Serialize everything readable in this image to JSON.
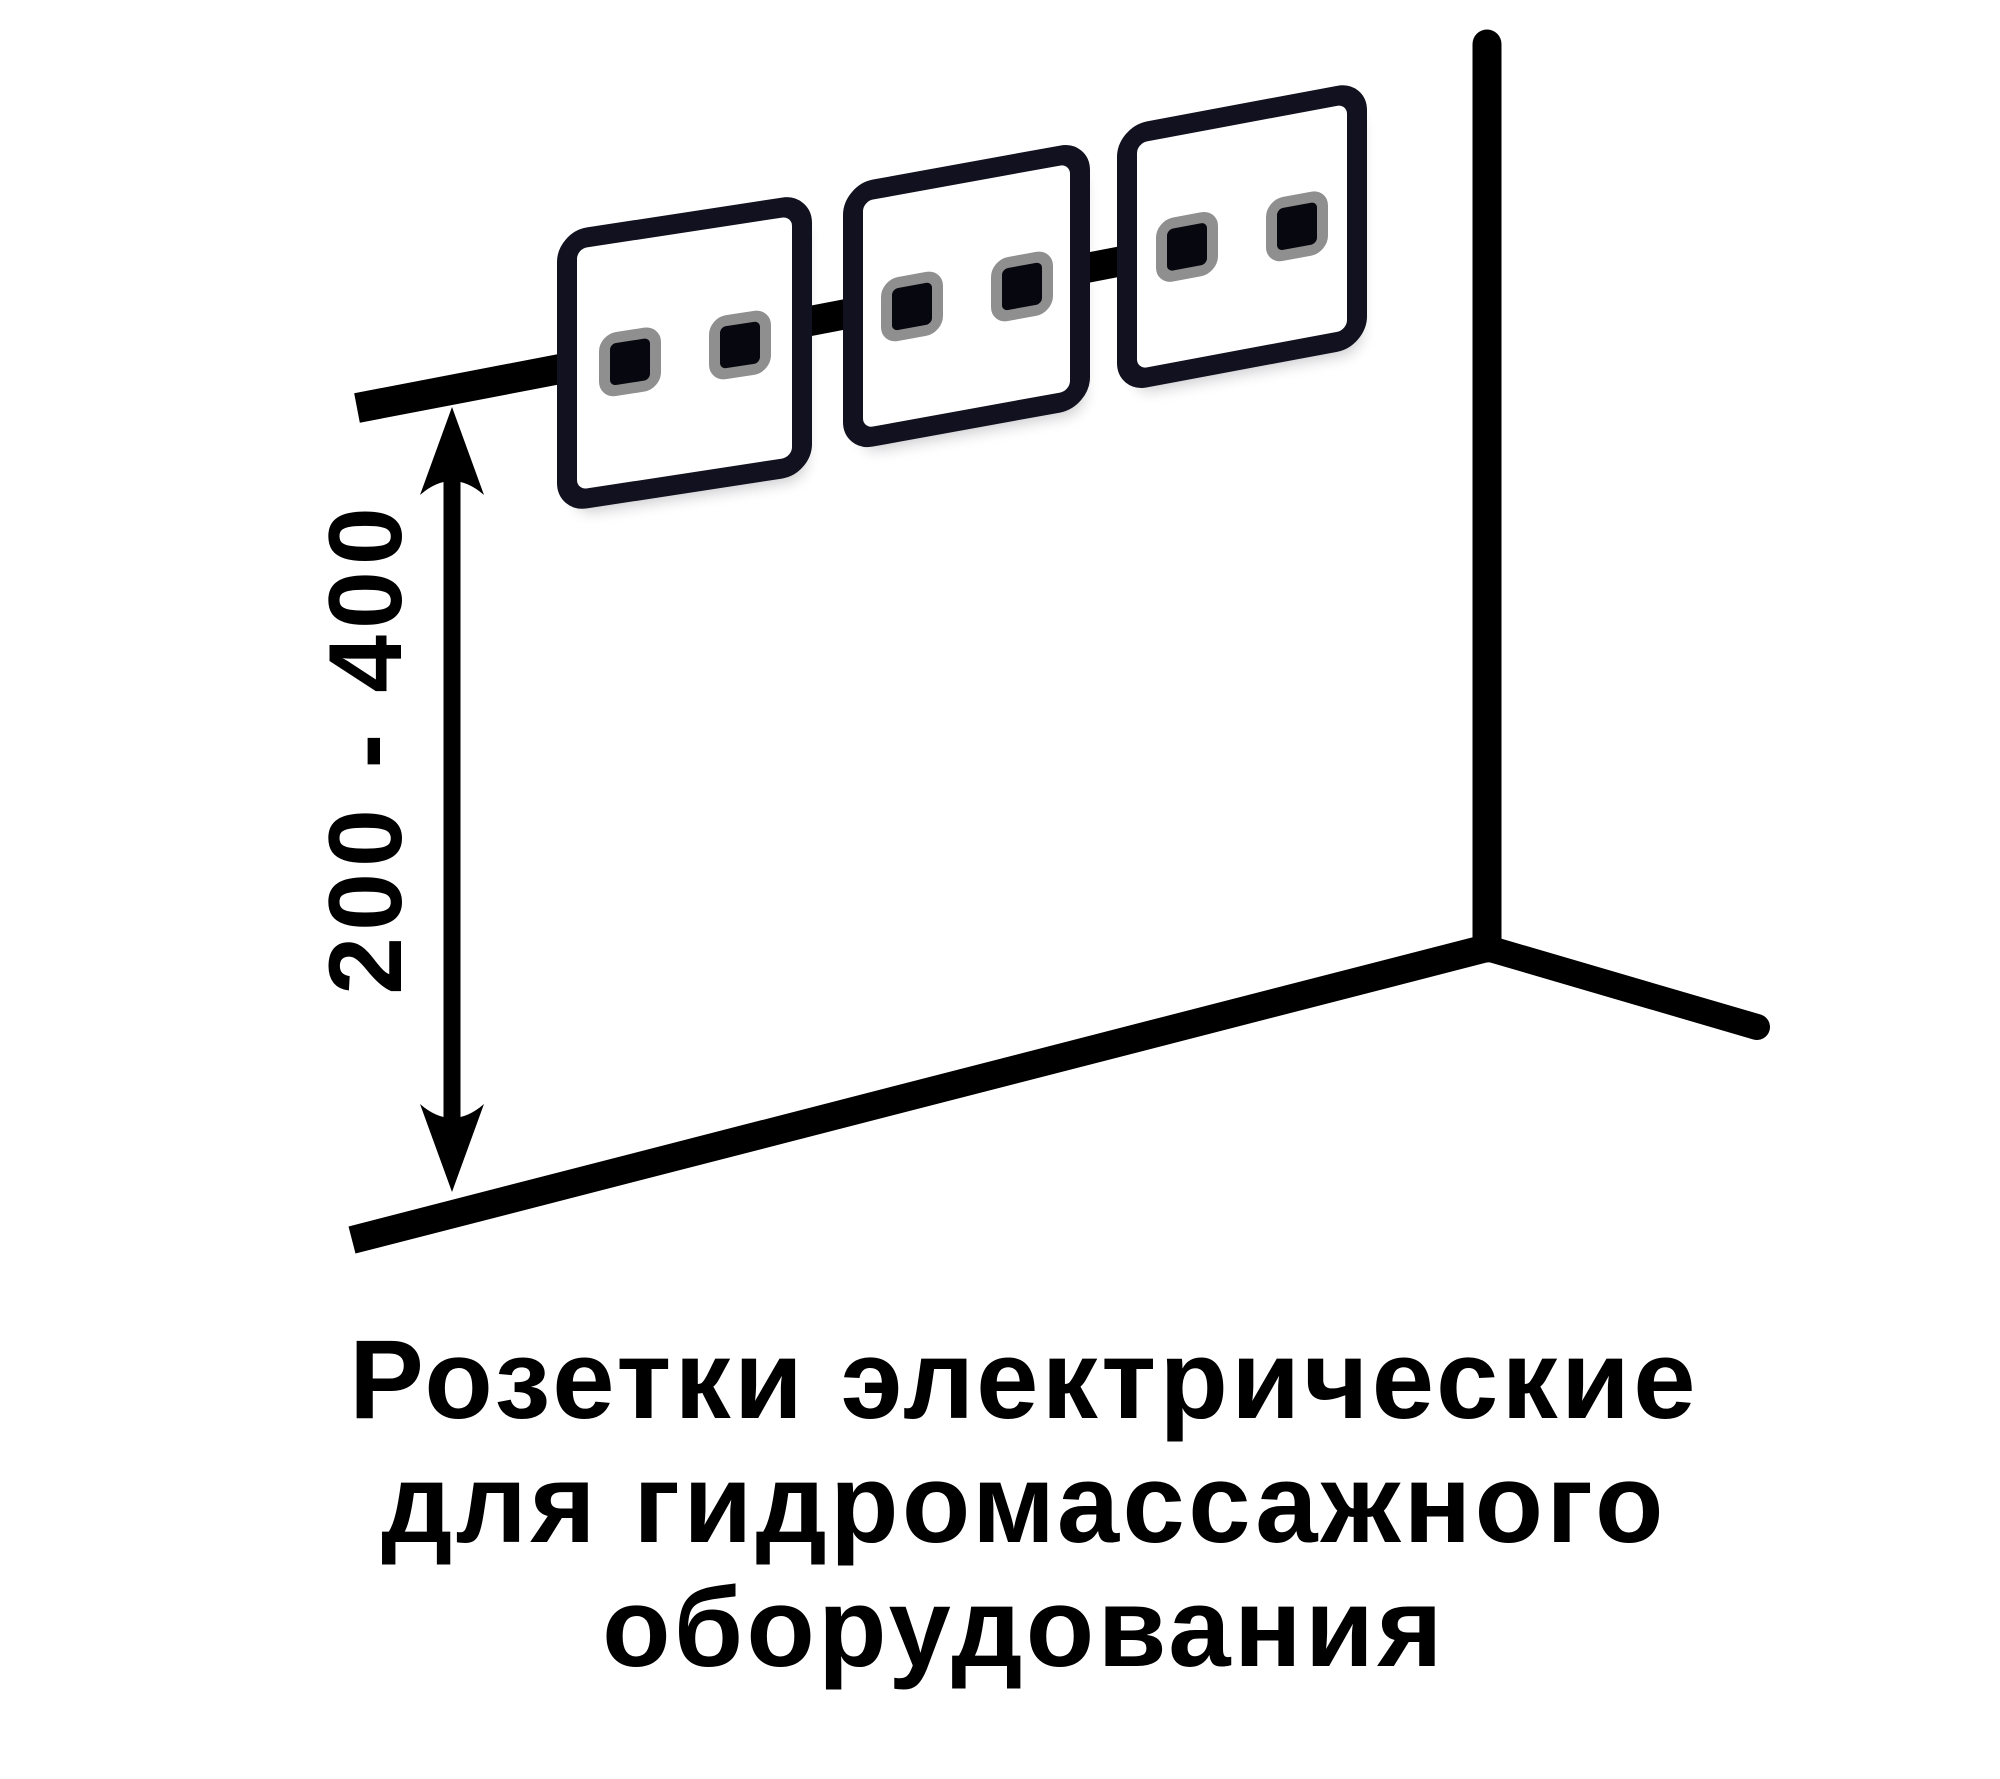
{
  "diagram": {
    "dimension_label": "200 - 400",
    "caption": {
      "line1": "Розетки электрические",
      "line2": "для гидромассажного",
      "line3": "оборудования"
    },
    "outlets": [
      {
        "id": 1,
        "socket_holes": 2
      },
      {
        "id": 2,
        "socket_holes": 2
      },
      {
        "id": 3,
        "socket_holes": 2
      }
    ],
    "colors": {
      "background": "#ffffff",
      "line": "#000000",
      "text": "#000000",
      "outlet_border": "#11111f",
      "socket_ring": "#8f8f8f",
      "socket_fill": "#07070f"
    }
  }
}
